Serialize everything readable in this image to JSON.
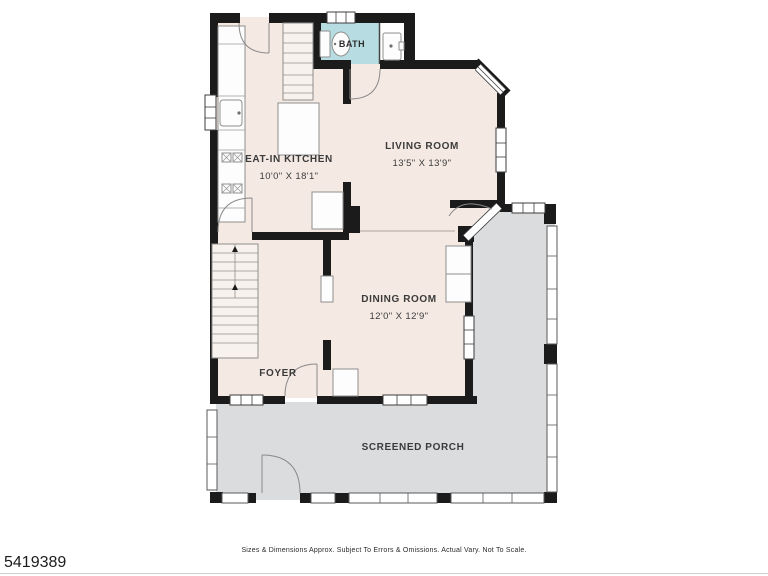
{
  "plan": {
    "rooms": {
      "bath": {
        "label": "BATH"
      },
      "kitchen": {
        "label": "EAT-IN KITCHEN",
        "dims": "10'0\" X 18'1\""
      },
      "living": {
        "label": "LIVING ROOM",
        "dims": "13'5\" X 13'9\""
      },
      "dining": {
        "label": "DINING ROOM",
        "dims": "12'0\" X 12'9\""
      },
      "foyer": {
        "label": "FOYER"
      },
      "porch": {
        "label": "SCREENED PORCH"
      }
    },
    "colors": {
      "room_fill": "#f4e9e3",
      "porch_fill": "#dbdcdd",
      "bath_fill": "#b7dde2",
      "wall": "#1b1b1b"
    }
  },
  "footer": {
    "listing_number": "5419389",
    "disclaimer": "Sizes & Dimensions Approx. Subject To Errors & Omissions. Actual Vary. Not To Scale."
  }
}
